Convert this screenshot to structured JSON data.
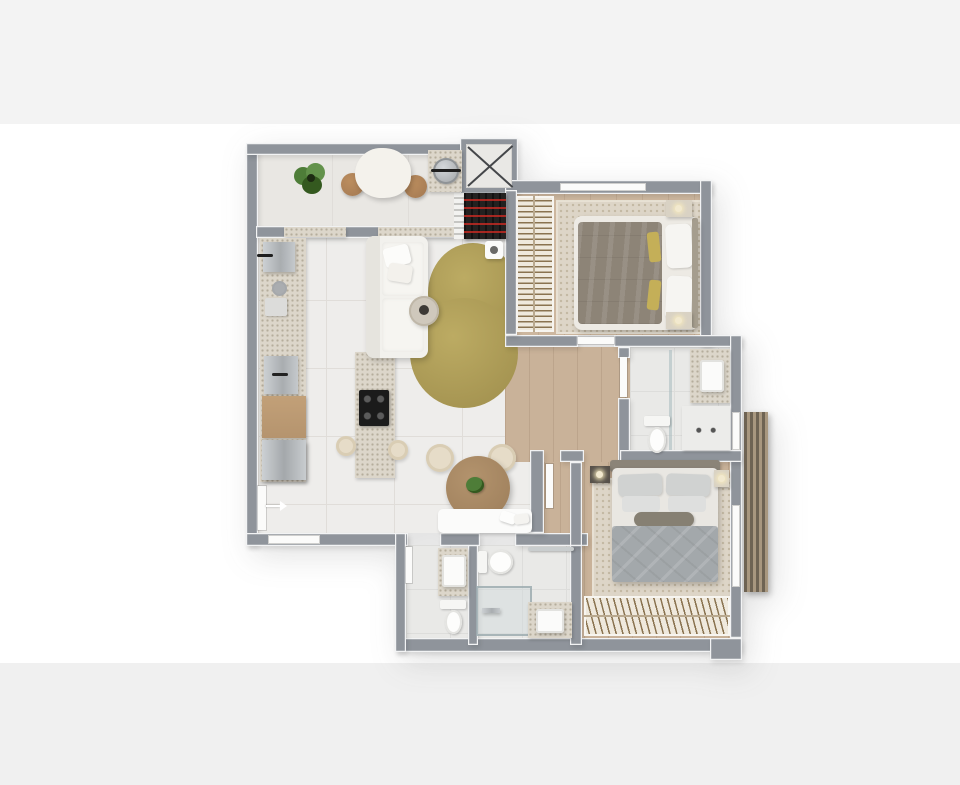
{
  "scene": {
    "description": "Top-down 3D rendered floor plan of a two-bedroom apartment, no text labels",
    "rooms": [
      {
        "id": "entry-hall"
      },
      {
        "id": "elevator-shaft"
      },
      {
        "id": "kitchen"
      },
      {
        "id": "living-room"
      },
      {
        "id": "dining-area"
      },
      {
        "id": "hallway"
      },
      {
        "id": "bedroom-1"
      },
      {
        "id": "bathroom-1"
      },
      {
        "id": "bedroom-2"
      },
      {
        "id": "bathroom-2"
      },
      {
        "id": "lavatory"
      },
      {
        "id": "facade-louvers"
      }
    ],
    "furniture": [
      "entry-table",
      "entry-stools",
      "potted-plant",
      "laundry-sink",
      "utility-shelf",
      "kitchen-counter",
      "sink-unit",
      "cooktop-island",
      "oven",
      "refrigerator",
      "sofa",
      "olive-rug",
      "coffee-table",
      "side-table",
      "dining-table",
      "dining-chairs",
      "bench",
      "double-bed-1",
      "wardrobe-1",
      "nightstands-1",
      "area-rug-1",
      "double-bed-2",
      "wardrobe-2",
      "nightstands-2",
      "area-rug-2",
      "toilets",
      "sinks",
      "showers",
      "vanities",
      "towel-bar"
    ]
  },
  "colors": {
    "pageBg": "#ffffff",
    "bandTop": "#f3f3f3",
    "bandBottom": "#f0f0f0",
    "wall": "#8f949b",
    "wallTrim": "#f2f3f4",
    "tile": "#eeedeb",
    "tileLine": "#e0ddd9",
    "entryFloor": "#e9e7e3",
    "wood": "#c9b299",
    "woodB1": "#cdb79f",
    "bathFloor": "#e9e9e7",
    "bathLine": "#dddddb",
    "granite": "#dcd6ca",
    "graniteDot": "#b5ad9c",
    "rugBeige": "#ddd5c7",
    "rugDot": "#c3b8a3",
    "rugOlive": "#a69552",
    "sofa": "#f2f1ed",
    "steel": "#b9bcbf",
    "stoolWood": "#a97e55",
    "tableWood": "#a2835f",
    "cabinetWood": "#c2a078",
    "duvet1": "#8d8477",
    "duvet2": "#a3a8ab",
    "pillow": "#f6f5f2",
    "gold": "#c4af58",
    "hanger": "#8a7350",
    "wardrobeBase": "#efe9dd",
    "louverDark": "#6e6353",
    "louverLight": "#a8977f",
    "white": "#fbfbfa",
    "darkShelf": "#232120",
    "shelfRed": "#cc2a22",
    "plant": "#4e7d38",
    "plantDark": "#34591f",
    "cooktop": "#1b1b1b"
  }
}
